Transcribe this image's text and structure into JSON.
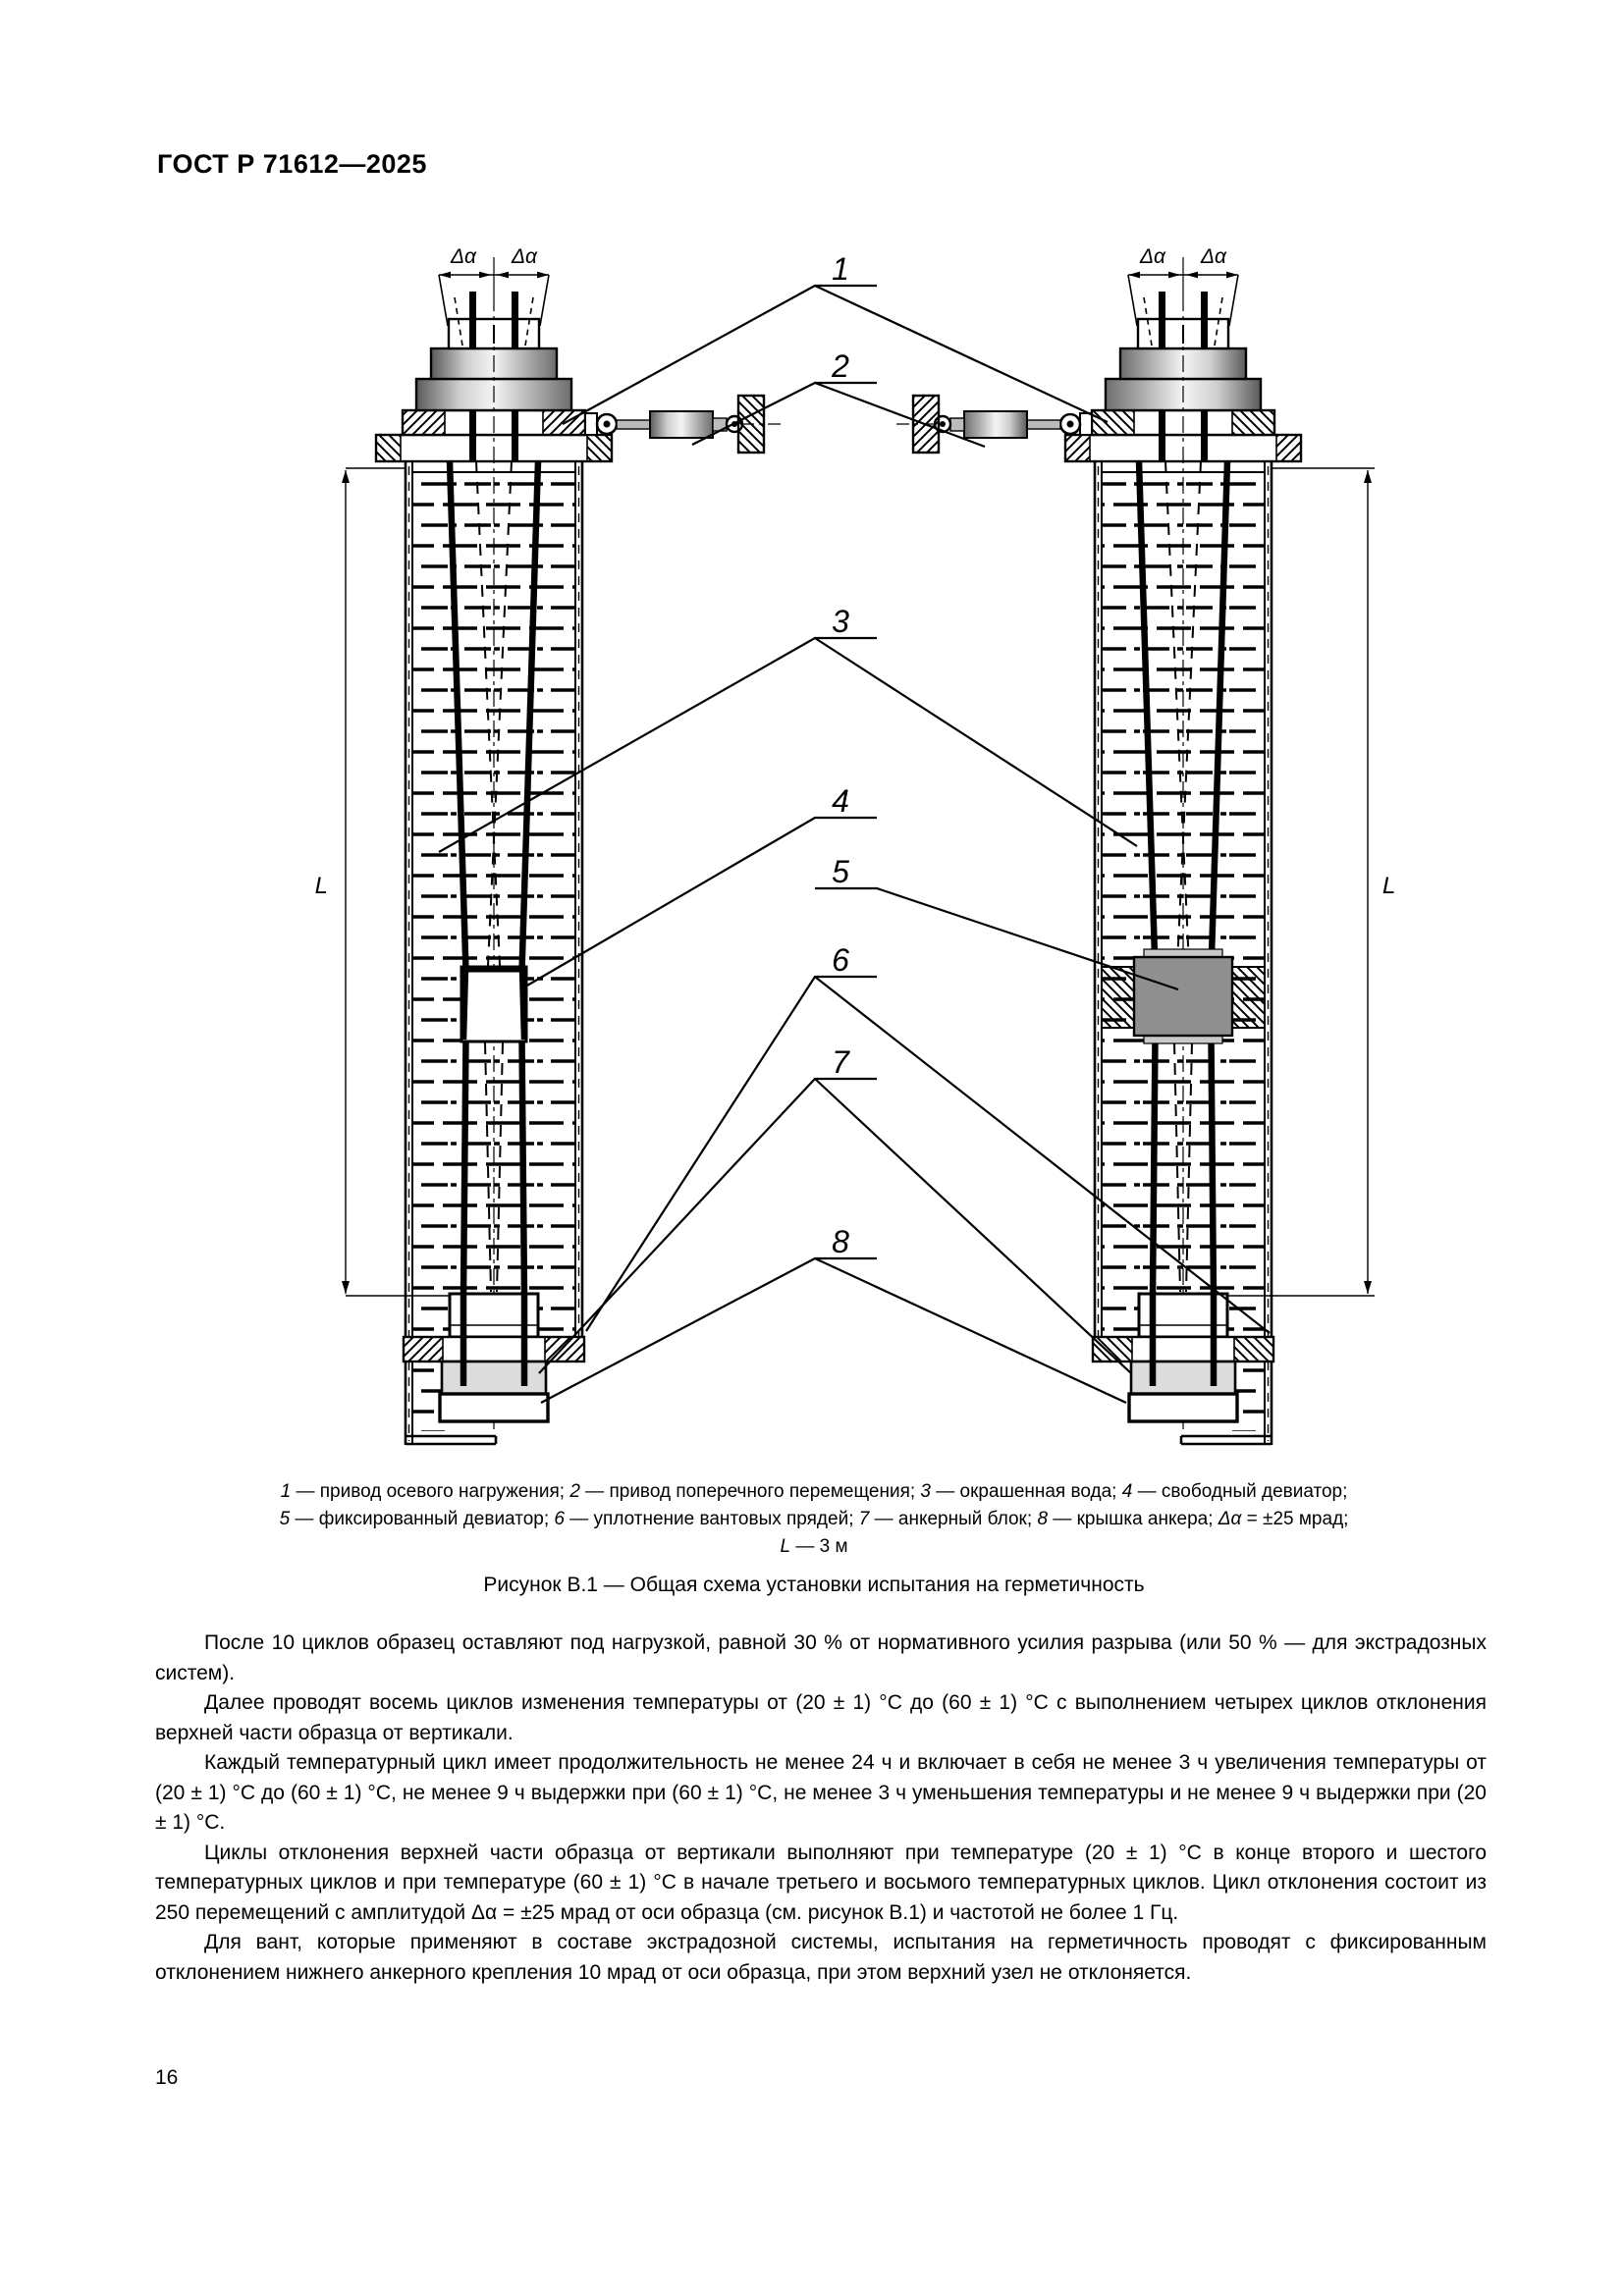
{
  "page": {
    "header": "ГОСТ Р 71612—2025",
    "number": "16"
  },
  "figure": {
    "callouts": {
      "c1": "1",
      "c2": "2",
      "c3": "3",
      "c4": "4",
      "c5": "5",
      "c6": "6",
      "c7": "7",
      "c8": "8"
    },
    "dims": {
      "delta_alpha": "Δα",
      "length": "L"
    },
    "legend_lines": [
      [
        {
          "i": "1"
        },
        {
          "t": " — привод осевого нагружения; "
        },
        {
          "i": "2"
        },
        {
          "t": " — привод поперечного перемещения; "
        },
        {
          "i": "3"
        },
        {
          "t": " — окрашенная вода; "
        },
        {
          "i": "4"
        },
        {
          "t": " — свободный девиатор;"
        }
      ],
      [
        {
          "i": "5"
        },
        {
          "t": " — фиксированный девиатор; "
        },
        {
          "i": "6"
        },
        {
          "t": " — уплотнение вантовых прядей; "
        },
        {
          "i": "7"
        },
        {
          "t": " — анкерный блок; "
        },
        {
          "i": "8"
        },
        {
          "t": " — крышка анкера; "
        },
        {
          "i": "Δα"
        },
        {
          "t": " = ±25 мрад;"
        }
      ],
      [
        {
          "i": "L"
        },
        {
          "t": " — 3 м"
        }
      ]
    ],
    "title": "Рисунок В.1 — Общая схема установки испытания на герметичность"
  },
  "paragraphs": [
    "После 10 циклов образец оставляют под нагрузкой, равной 30 % от нормативного усилия разрыва (или 50 % — для экстрадозных систем).",
    "Далее проводят восемь циклов изменения температуры от (20 ± 1) °С до (60 ± 1) °С с выполнением четырех циклов отклонения верхней части образца от вертикали.",
    "Каждый температурный цикл имеет продолжительность не менее 24 ч и включает в себя не менее 3 ч увеличения температуры от (20 ± 1) °С до (60 ± 1) °С, не менее 9 ч выдержки при (60 ± 1) °С, не менее 3 ч уменьшения температуры и не менее 9 ч выдержки при (20 ± 1) °С.",
    "Циклы отклонения верхней части образца от вертикали выполняют при температуре (20 ± 1) °С в конце второго и шестого температурных циклов и при температуре (60 ± 1) °С в начале третьего и восьмого температурных циклов. Цикл отклонения состоит из 250 перемещений с амплитудой Δα = ±25 мрад от оси образца (см. рисунок В.1) и частотой не более 1 Гц.",
    "Для вант, которые применяют в составе экстрадозной системы, испытания на герметичность проводят с фиксированным отклонением нижнего анкерного крепления 10 мрад от оси образца, при этом верхний узел не отклоняется."
  ]
}
